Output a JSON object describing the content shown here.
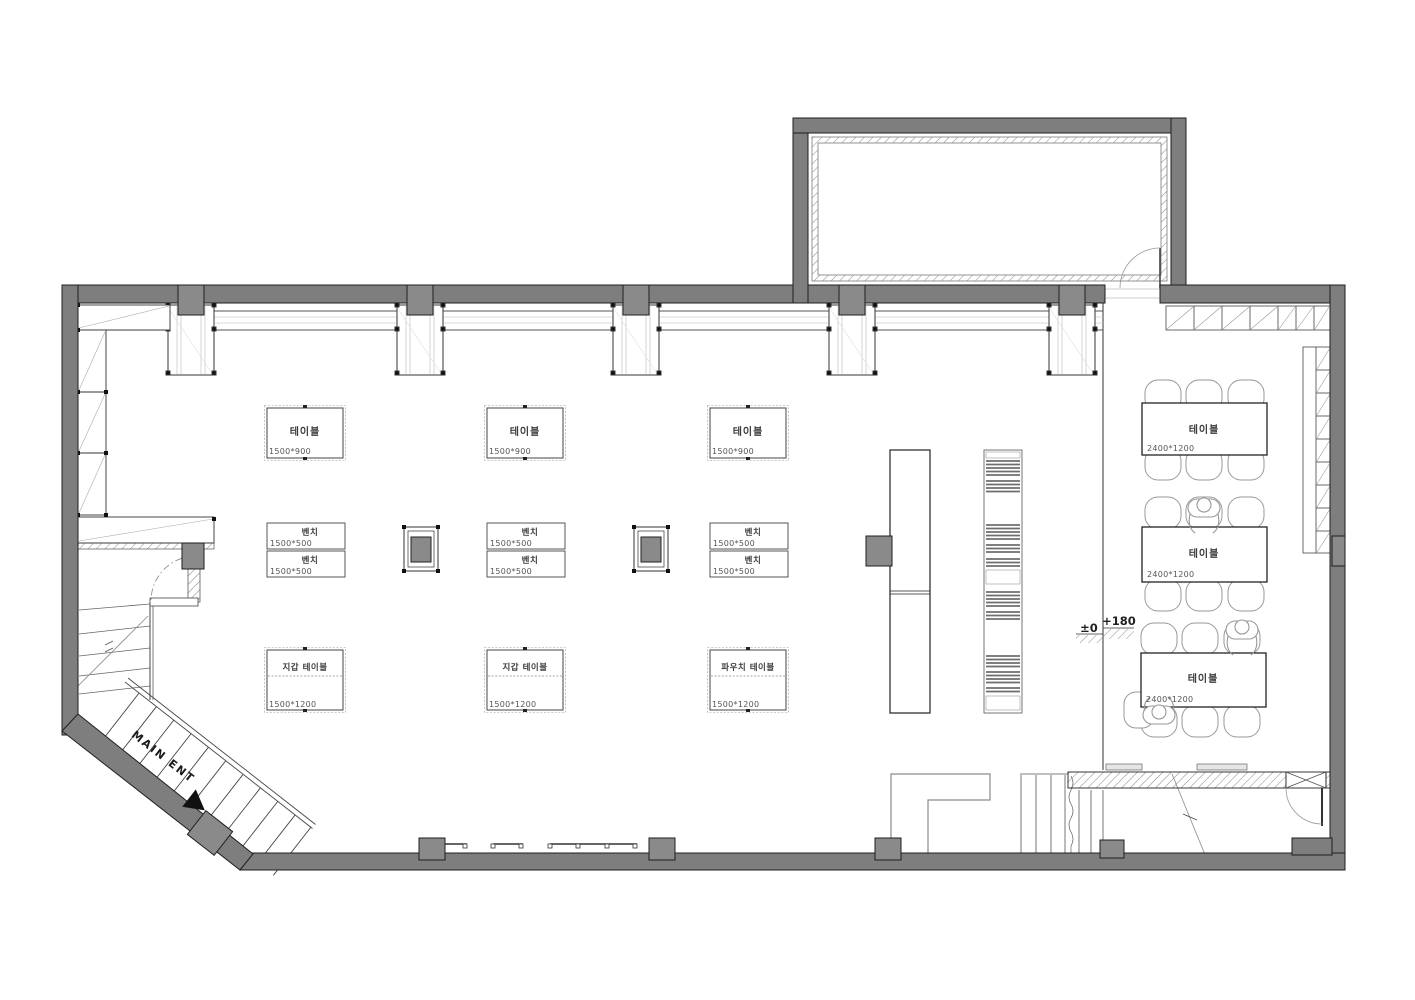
{
  "title": "floor-plan",
  "palette": {
    "wall_fill": "#7e7e7e",
    "column_fill": "#8a8a8a",
    "outline": "#1f1f1f",
    "furniture_line": "#444444",
    "light_line": "#bbbbbb",
    "accent_black": "#111111"
  },
  "entrance": {
    "label": "MAIN ENT"
  },
  "levels": {
    "ground": "±0",
    "raised": "+180"
  },
  "display_tables": [
    {
      "label": "테이블",
      "dim": "1500*900"
    },
    {
      "label": "테이블",
      "dim": "1500*900"
    },
    {
      "label": "테이블",
      "dim": "1500*900"
    }
  ],
  "benches": [
    {
      "label": "벤치",
      "dim": "1500*500"
    },
    {
      "label": "벤치",
      "dim": "1500*500"
    },
    {
      "label": "벤치",
      "dim": "1500*500"
    },
    {
      "label": "벤치",
      "dim": "1500*500"
    },
    {
      "label": "벤치",
      "dim": "1500*500"
    },
    {
      "label": "벤치",
      "dim": "1500*500"
    }
  ],
  "product_tables": [
    {
      "label": "지갑 테이블",
      "dim": "1500*1200"
    },
    {
      "label": "지갑 테이블",
      "dim": "1500*1200"
    },
    {
      "label": "파우치 테이블",
      "dim": "1500*1200"
    }
  ],
  "seating_tables": [
    {
      "label": "테이블",
      "dim": "2400*1200"
    },
    {
      "label": "테이블",
      "dim": "2400*1200"
    },
    {
      "label": "테이블",
      "dim": "2400*1200"
    }
  ]
}
